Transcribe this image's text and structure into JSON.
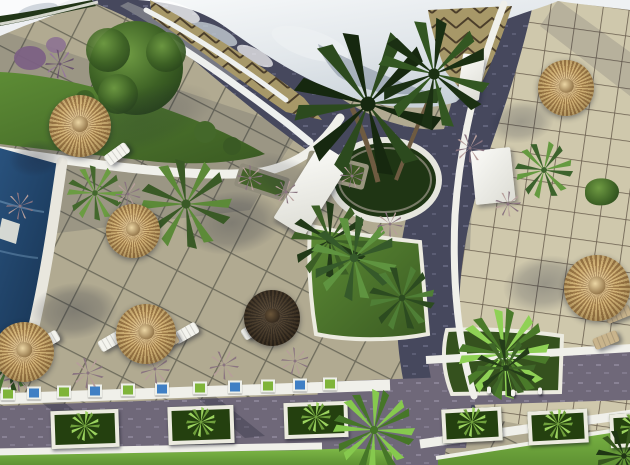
{
  "meta": {
    "title": "Aerial 3D architectural render of a resort courtyard",
    "width": 630,
    "height": 465,
    "description": "Top-down render: curved white roof at top, chevron-tiled curved terrace, dark stone paths, two paved tile terraces with straw parasols and sun loungers, swimming pool at left edge, central palm planter, green garden strips, bottom pedestrian walkway with white planter boxes and bright lawns"
  },
  "scene": {
    "palette": {
      "straw1": "#d8b97c",
      "straw2": "#a07c4a",
      "strawd1": "#54422b",
      "strawd2": "#362a1c",
      "lounger": "#f4f4ee",
      "wood": "#c9b48c",
      "box_frame": "#ecebe0",
      "box_soil": "#24400f",
      "cube_blue": "#3f7fc4",
      "cube_green": "#7fb43a",
      "fig": "#f5f5f0",
      "roof_white": "#e9edf0",
      "path_dark": "#46485d",
      "walkway_mauve": "#6f6879",
      "tile_left": "#b1aa91",
      "tile_right": "#cfc8ac",
      "zigzag_tile": "#a79868",
      "pool_blue": "#1d3c5e",
      "grass_bright": "#72ad3f",
      "garden_dark": "#324d20"
    },
    "umbrellas": [
      {
        "x": 80,
        "y": 126,
        "r": 31,
        "v": "straw"
      },
      {
        "x": 133,
        "y": 231,
        "r": 27,
        "v": "straw"
      },
      {
        "x": 146,
        "y": 334,
        "r": 30,
        "v": "straw"
      },
      {
        "x": 24,
        "y": 352,
        "r": 30,
        "v": "straw"
      },
      {
        "x": 272,
        "y": 318,
        "r": 28,
        "v": "dark"
      },
      {
        "x": 566,
        "y": 88,
        "r": 28,
        "v": "straw"
      },
      {
        "x": 597,
        "y": 288,
        "r": 33,
        "v": "straw"
      }
    ],
    "shadows": [
      {
        "x": 36,
        "y": 158,
        "w": 54,
        "h": 36,
        "rot": -8,
        "o": 0.55
      },
      {
        "x": 232,
        "y": 223,
        "w": 100,
        "h": 62,
        "rot": -8,
        "o": 0.6
      },
      {
        "x": 74,
        "y": 311,
        "w": 88,
        "h": 56,
        "rot": -6,
        "o": 0.6
      },
      {
        "x": 545,
        "y": 284,
        "w": 84,
        "h": 56,
        "rot": -10,
        "o": 0.55
      },
      {
        "x": 521,
        "y": 122,
        "w": 66,
        "h": 42,
        "rot": -8,
        "o": 0.5
      },
      {
        "x": 300,
        "y": 186,
        "w": 120,
        "h": 44,
        "rot": 28,
        "o": 0.35
      },
      {
        "x": 140,
        "y": 120,
        "w": 150,
        "h": 60,
        "rot": -18,
        "o": 0.3
      }
    ],
    "loungers": [
      {
        "x": 117,
        "y": 154,
        "rot": -36,
        "v": "white"
      },
      {
        "x": 47,
        "y": 341,
        "rot": -30,
        "v": "white"
      },
      {
        "x": 111,
        "y": 341,
        "rot": -30,
        "v": "white"
      },
      {
        "x": 186,
        "y": 333,
        "rot": -30,
        "v": "white"
      },
      {
        "x": 254,
        "y": 329,
        "rot": -32,
        "v": "white"
      },
      {
        "x": 166,
        "y": 343,
        "rot": -30,
        "v": "wood"
      },
      {
        "x": 618,
        "y": 314,
        "rot": -22,
        "v": "wood"
      },
      {
        "x": 606,
        "y": 340,
        "rot": -22,
        "v": "wood"
      }
    ],
    "planter_boxes": [
      {
        "x": 55,
        "y": 414,
        "w": 60,
        "h": 30,
        "rot": -2
      },
      {
        "x": 172,
        "y": 410,
        "w": 58,
        "h": 30,
        "rot": -2
      },
      {
        "x": 288,
        "y": 406,
        "w": 56,
        "h": 28,
        "rot": -2
      },
      {
        "x": 446,
        "y": 412,
        "w": 52,
        "h": 26,
        "rot": -3
      },
      {
        "x": 532,
        "y": 414,
        "w": 52,
        "h": 26,
        "rot": -3
      },
      {
        "x": 614,
        "y": 417,
        "w": 42,
        "h": 26,
        "rot": -3
      }
    ],
    "accent_planters": [
      {
        "x": 8,
        "y": 394,
        "c": "g"
      },
      {
        "x": 34,
        "y": 393,
        "c": "b"
      },
      {
        "x": 64,
        "y": 392,
        "c": "g"
      },
      {
        "x": 95,
        "y": 391,
        "c": "b"
      },
      {
        "x": 128,
        "y": 390,
        "c": "g"
      },
      {
        "x": 162,
        "y": 389,
        "c": "b"
      },
      {
        "x": 200,
        "y": 388,
        "c": "g"
      },
      {
        "x": 235,
        "y": 387,
        "c": "b"
      },
      {
        "x": 268,
        "y": 386,
        "c": "g"
      },
      {
        "x": 300,
        "y": 385,
        "c": "b"
      },
      {
        "x": 330,
        "y": 384,
        "c": "g"
      }
    ],
    "plants": [
      {
        "t": "palm",
        "x": 368,
        "y": 104,
        "s": 150,
        "c1": "#16280f",
        "c2": "#2c4a1e"
      },
      {
        "t": "palm",
        "x": 434,
        "y": 74,
        "s": 112,
        "c1": "#1b3013",
        "c2": "#335722"
      },
      {
        "t": "palm",
        "x": 186,
        "y": 204,
        "s": 92,
        "c1": "#3a5a26",
        "c2": "#5c8a38"
      },
      {
        "t": "palm",
        "x": 95,
        "y": 193,
        "s": 56,
        "c1": "#43682c",
        "c2": "#6b9c42"
      },
      {
        "t": "palm",
        "x": 330,
        "y": 240,
        "s": 78,
        "c1": "#223a18",
        "c2": "#3c5f26"
      },
      {
        "t": "palm",
        "x": 354,
        "y": 258,
        "s": 86,
        "c1": "#35592a",
        "c2": "#5f9440"
      },
      {
        "t": "palm",
        "x": 402,
        "y": 298,
        "s": 66,
        "c1": "#2c4b20",
        "c2": "#4f7f36"
      },
      {
        "t": "fan",
        "x": 504,
        "y": 354,
        "s": 92,
        "c1": "#4a7a2a",
        "c2": "#8fd155"
      },
      {
        "t": "fan",
        "x": 374,
        "y": 430,
        "s": 82,
        "c1": "#467628",
        "c2": "#86c94e"
      },
      {
        "t": "palm",
        "x": 8,
        "y": 366,
        "s": 52,
        "c1": "#2c4a1e",
        "c2": "#497530"
      },
      {
        "t": "palm",
        "x": 506,
        "y": 368,
        "s": 60,
        "c1": "#243d19",
        "c2": "#3f6628"
      },
      {
        "t": "palm",
        "x": 624,
        "y": 456,
        "s": 56,
        "c1": "#1f3614",
        "c2": "#38591f"
      },
      {
        "t": "palm",
        "x": 544,
        "y": 170,
        "s": 58,
        "c1": "#3c632c",
        "c2": "#659a40"
      },
      {
        "t": "bush",
        "x": 602,
        "y": 192,
        "s": 34
      },
      {
        "t": "tuft",
        "x": 470,
        "y": 148,
        "s": 30
      },
      {
        "t": "tuft",
        "x": 508,
        "y": 204,
        "s": 26
      },
      {
        "t": "tuft",
        "x": 18,
        "y": 377,
        "s": 30
      },
      {
        "t": "tuft",
        "x": 88,
        "y": 373,
        "s": 32
      },
      {
        "t": "tuft",
        "x": 155,
        "y": 369,
        "s": 30
      },
      {
        "t": "tuft",
        "x": 224,
        "y": 365,
        "s": 30
      },
      {
        "t": "tuft",
        "x": 295,
        "y": 361,
        "s": 28
      },
      {
        "t": "tuft",
        "x": 20,
        "y": 206,
        "s": 28
      },
      {
        "t": "tuft",
        "x": 128,
        "y": 194,
        "s": 26
      },
      {
        "t": "tuft",
        "x": 250,
        "y": 178,
        "s": 26
      },
      {
        "t": "tuft",
        "x": 286,
        "y": 192,
        "s": 24
      },
      {
        "t": "tuft",
        "x": 390,
        "y": 224,
        "s": 26
      },
      {
        "t": "tuft",
        "x": 352,
        "y": 176,
        "s": 24
      },
      {
        "t": "tuft",
        "x": 60,
        "y": 64,
        "s": 30,
        "c1": "#6b5570",
        "c2": "#96789c"
      }
    ],
    "structures": [
      {
        "n": "white-ramp",
        "x": 312,
        "y": 190,
        "w": 36,
        "h": 88,
        "rot": 32
      },
      {
        "n": "white-block",
        "x": 493,
        "y": 176,
        "w": 40,
        "h": 54,
        "rot": -6
      },
      {
        "n": "white-pillar",
        "x": 471,
        "y": 77,
        "w": 22,
        "h": 45,
        "rot": 8
      }
    ],
    "figures": [
      {
        "x": 489,
        "y": 390
      },
      {
        "x": 513,
        "y": 393
      },
      {
        "x": 540,
        "y": 391
      }
    ]
  }
}
